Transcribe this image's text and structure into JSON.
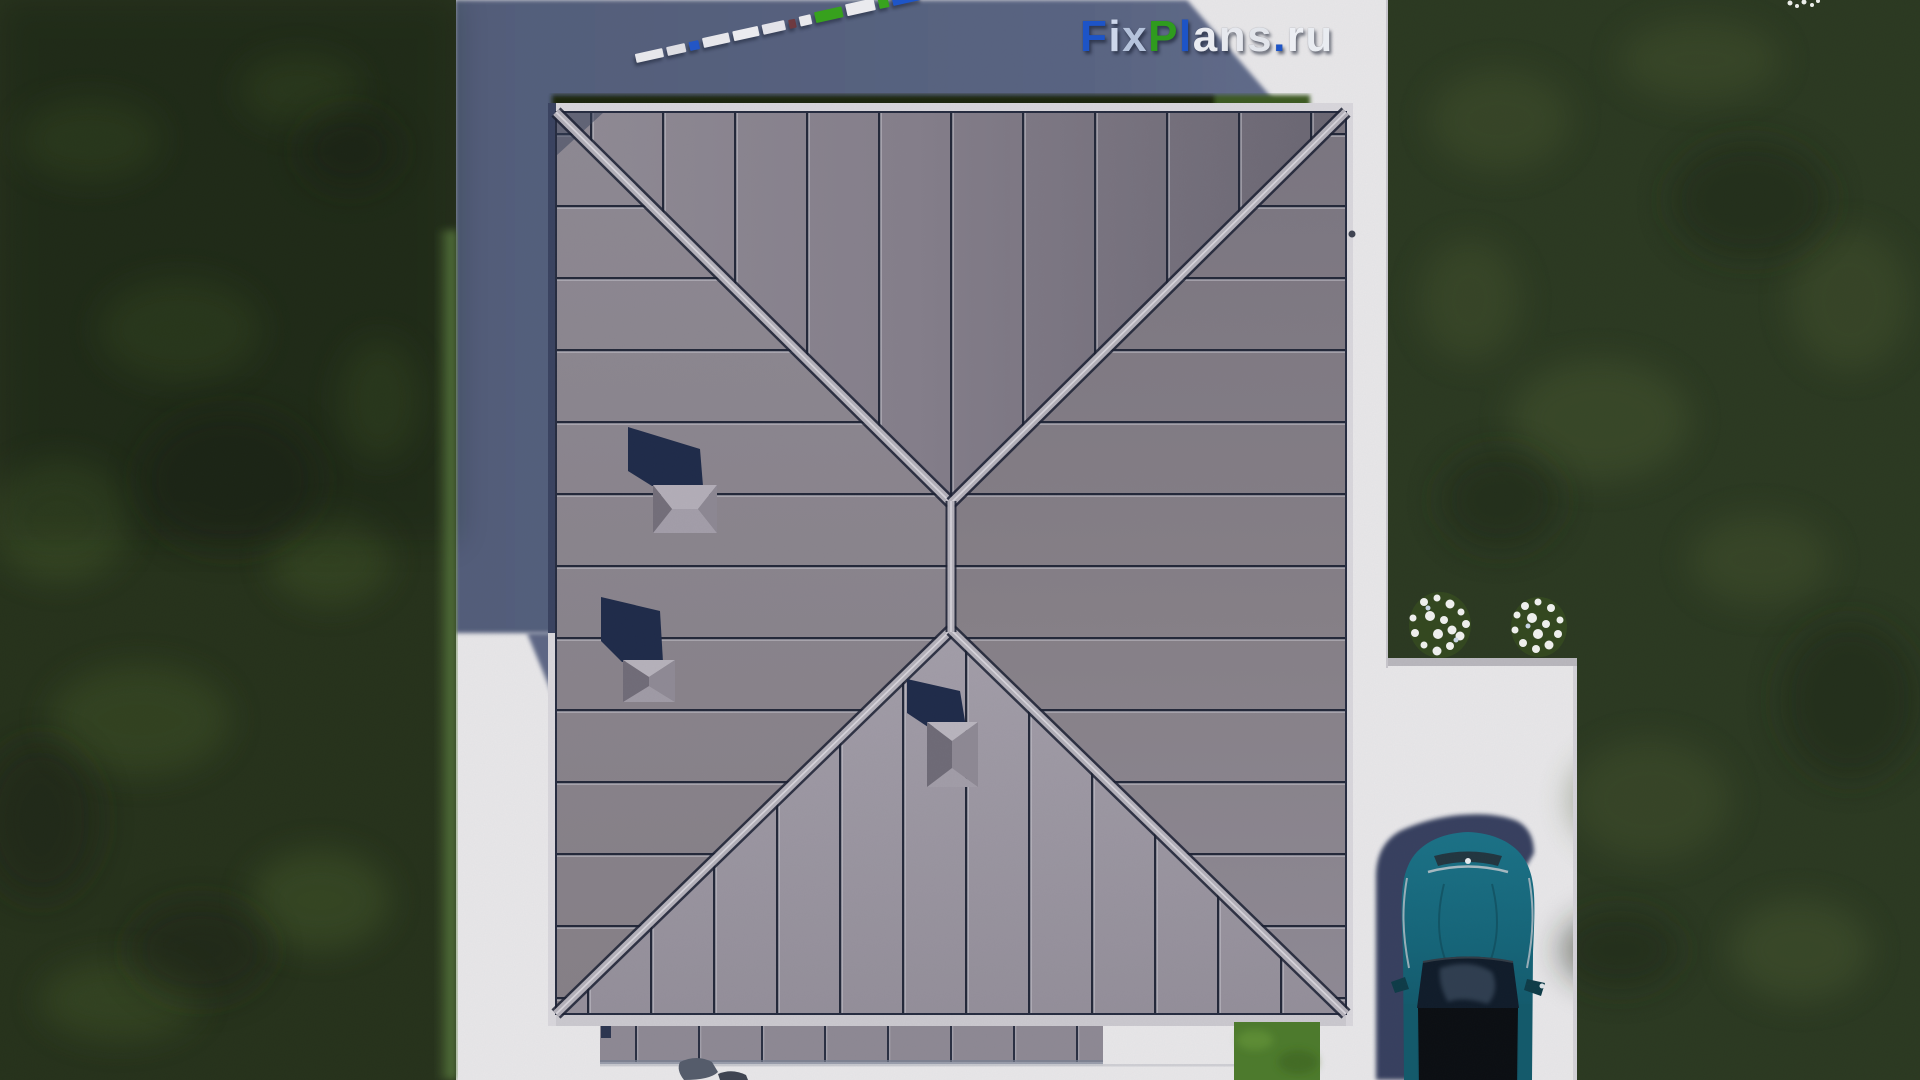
{
  "watermark": {
    "text": "FixPlans.ru",
    "letters": [
      {
        "ch": "F",
        "style": "color:#1d54c7"
      },
      {
        "ch": "i",
        "style": "color:#cdd7eb"
      },
      {
        "ch": "x",
        "style": "color:#b5c3dc"
      },
      {
        "ch": "P",
        "style": "color:#2f9b1e"
      },
      {
        "ch": "l",
        "style": "color:#1d54c7"
      },
      {
        "ch": "a",
        "style": "color:#e9ebf1"
      },
      {
        "ch": "n",
        "style": "color:#e6e8ee"
      },
      {
        "ch": "s",
        "style": "color:#e2e5eb"
      },
      {
        "ch": ".",
        "style": "color:#1d54c7"
      },
      {
        "ch": "r",
        "style": "color:#edeff4"
      },
      {
        "ch": "u",
        "style": "color:#e9ecf1"
      }
    ]
  },
  "train": {
    "blocks": [
      {
        "style": "width:28px;height:9px;background:#e7e7eb"
      },
      {
        "style": "width:19px;height:9px;background:#dedee4"
      },
      {
        "style": "width:10px;height:9px;background:#2356c6"
      },
      {
        "style": "width:27px;height:10px;background:#e7e7eb"
      },
      {
        "style": "width:26px;height:10px;background:#ebebef"
      },
      {
        "style": "width:23px;height:10px;background:#e3e3e9"
      },
      {
        "style": "width:7px;height:9px;background:#6e3a40"
      },
      {
        "style": "width:12px;height:10px;background:#e8e8ec"
      },
      {
        "style": "width:28px;height:11px;background:#37a11d"
      },
      {
        "style": "width:29px;height:12px;background:#eaeaee"
      },
      {
        "style": "width:10px;height:10px;background:#38a31e"
      },
      {
        "style": "width:29px;height:17px;background:#1e55c8"
      }
    ]
  },
  "palette": {
    "lawn_green": "#26321b",
    "lawn_patch": "#3f5427",
    "lit_lawn": "#4d7b2c",
    "concrete": "#e8e7e9",
    "shadow_blue": "#57627f",
    "roof_north": "#7f7a86",
    "roof_east": "#85808b",
    "roof_south": "#9b96a1",
    "roof_west": "#8a8590",
    "seam": "#232839",
    "hip_band": "#b4b1ba",
    "vent_shadow": "#1f2b4a",
    "hedge": "#1b2711",
    "hedge_lit": "#3c5a23",
    "flowers": "#f1f2ef",
    "car_body": "#16647a",
    "car_glass": "#101c2a",
    "car_roof": "#0b0e12",
    "car_shadow": "#2d3959",
    "logo_blue": "#1d54c7",
    "logo_green": "#2f9b1e",
    "logo_light": "#e9ebf1"
  }
}
